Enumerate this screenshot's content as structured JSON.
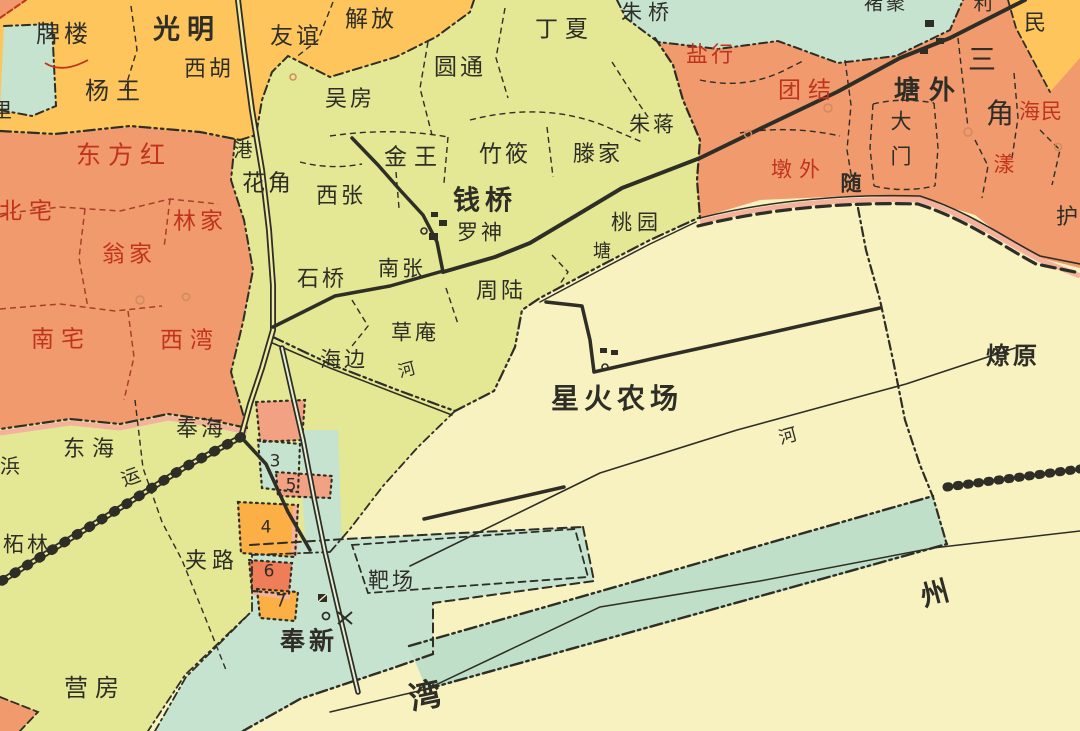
{
  "map": {
    "colors": {
      "yellow_region": "#fdc55c",
      "orange_region": "#f19a6e",
      "green_region": "#e4e794",
      "cream_region": "#f8f1c0",
      "teal_region": "#c6e3cf",
      "teal_band": "#bfdfc8",
      "patch_orange": "#fcaf45",
      "patch_salmon": "#ef7d58",
      "patch_pink": "#f2a182",
      "pink_shadow": "#f4b29c",
      "red_label": "#c0341e",
      "black_ink": "#2e2e26"
    },
    "labels": {
      "pailou": "牌楼",
      "guangming": "光明",
      "xihu": "西胡",
      "yangwang": "杨王",
      "youyi": "友谊",
      "jiefang": "解放",
      "wufang": "吴房",
      "yuantong": "圆通",
      "dingxia": "丁夏",
      "zhuqiao": "朱桥",
      "gang": "港",
      "huajiao": "花角",
      "xizhang": "西张",
      "jinwang": "金王",
      "zhuxiao": "竹筱",
      "tengjia": "滕家",
      "zhujiang": "朱蒋",
      "qianqiao": "钱桥",
      "luoshen": "罗神",
      "nanzhang": "南张",
      "shiqiao": "石桥",
      "zhoulu": "周陆",
      "caoan": "草庵",
      "haibian": "海边",
      "he1": "河",
      "taoyuan": "桃园",
      "tang": "塘",
      "donghai": "东海",
      "fenghai": "奉海",
      "yun": "运",
      "bang": "浜",
      "zhelin": "柘林",
      "jialu": "夹路",
      "yingfang": "营房",
      "bachang": "靶场",
      "fengxin": "奉新",
      "wan": "湾",
      "zhou": "州",
      "xinghuo": "星火农场",
      "he2": "河",
      "liaoyuan": "燎原",
      "yanhang": "盐行",
      "tuanjie": "团结",
      "tangwai": "塘外",
      "da": "大",
      "men": "门",
      "san": "三",
      "jiao": "角",
      "haimin": "海民",
      "yang": "漾",
      "hu": "护",
      "dunwai": "墩外",
      "sui": "随",
      "chuju": "褚聚",
      "li": "利",
      "min": "民",
      "beizhai": "北宅",
      "dongfanghong": "东方红",
      "linjia": "林家",
      "wengjia": "翁家",
      "nanzhai": "南宅",
      "xiwan": "西湾",
      "licorner": "里",
      "n3": "3",
      "n5": "5",
      "n4": "4",
      "n6": "6",
      "n7": "7"
    }
  }
}
